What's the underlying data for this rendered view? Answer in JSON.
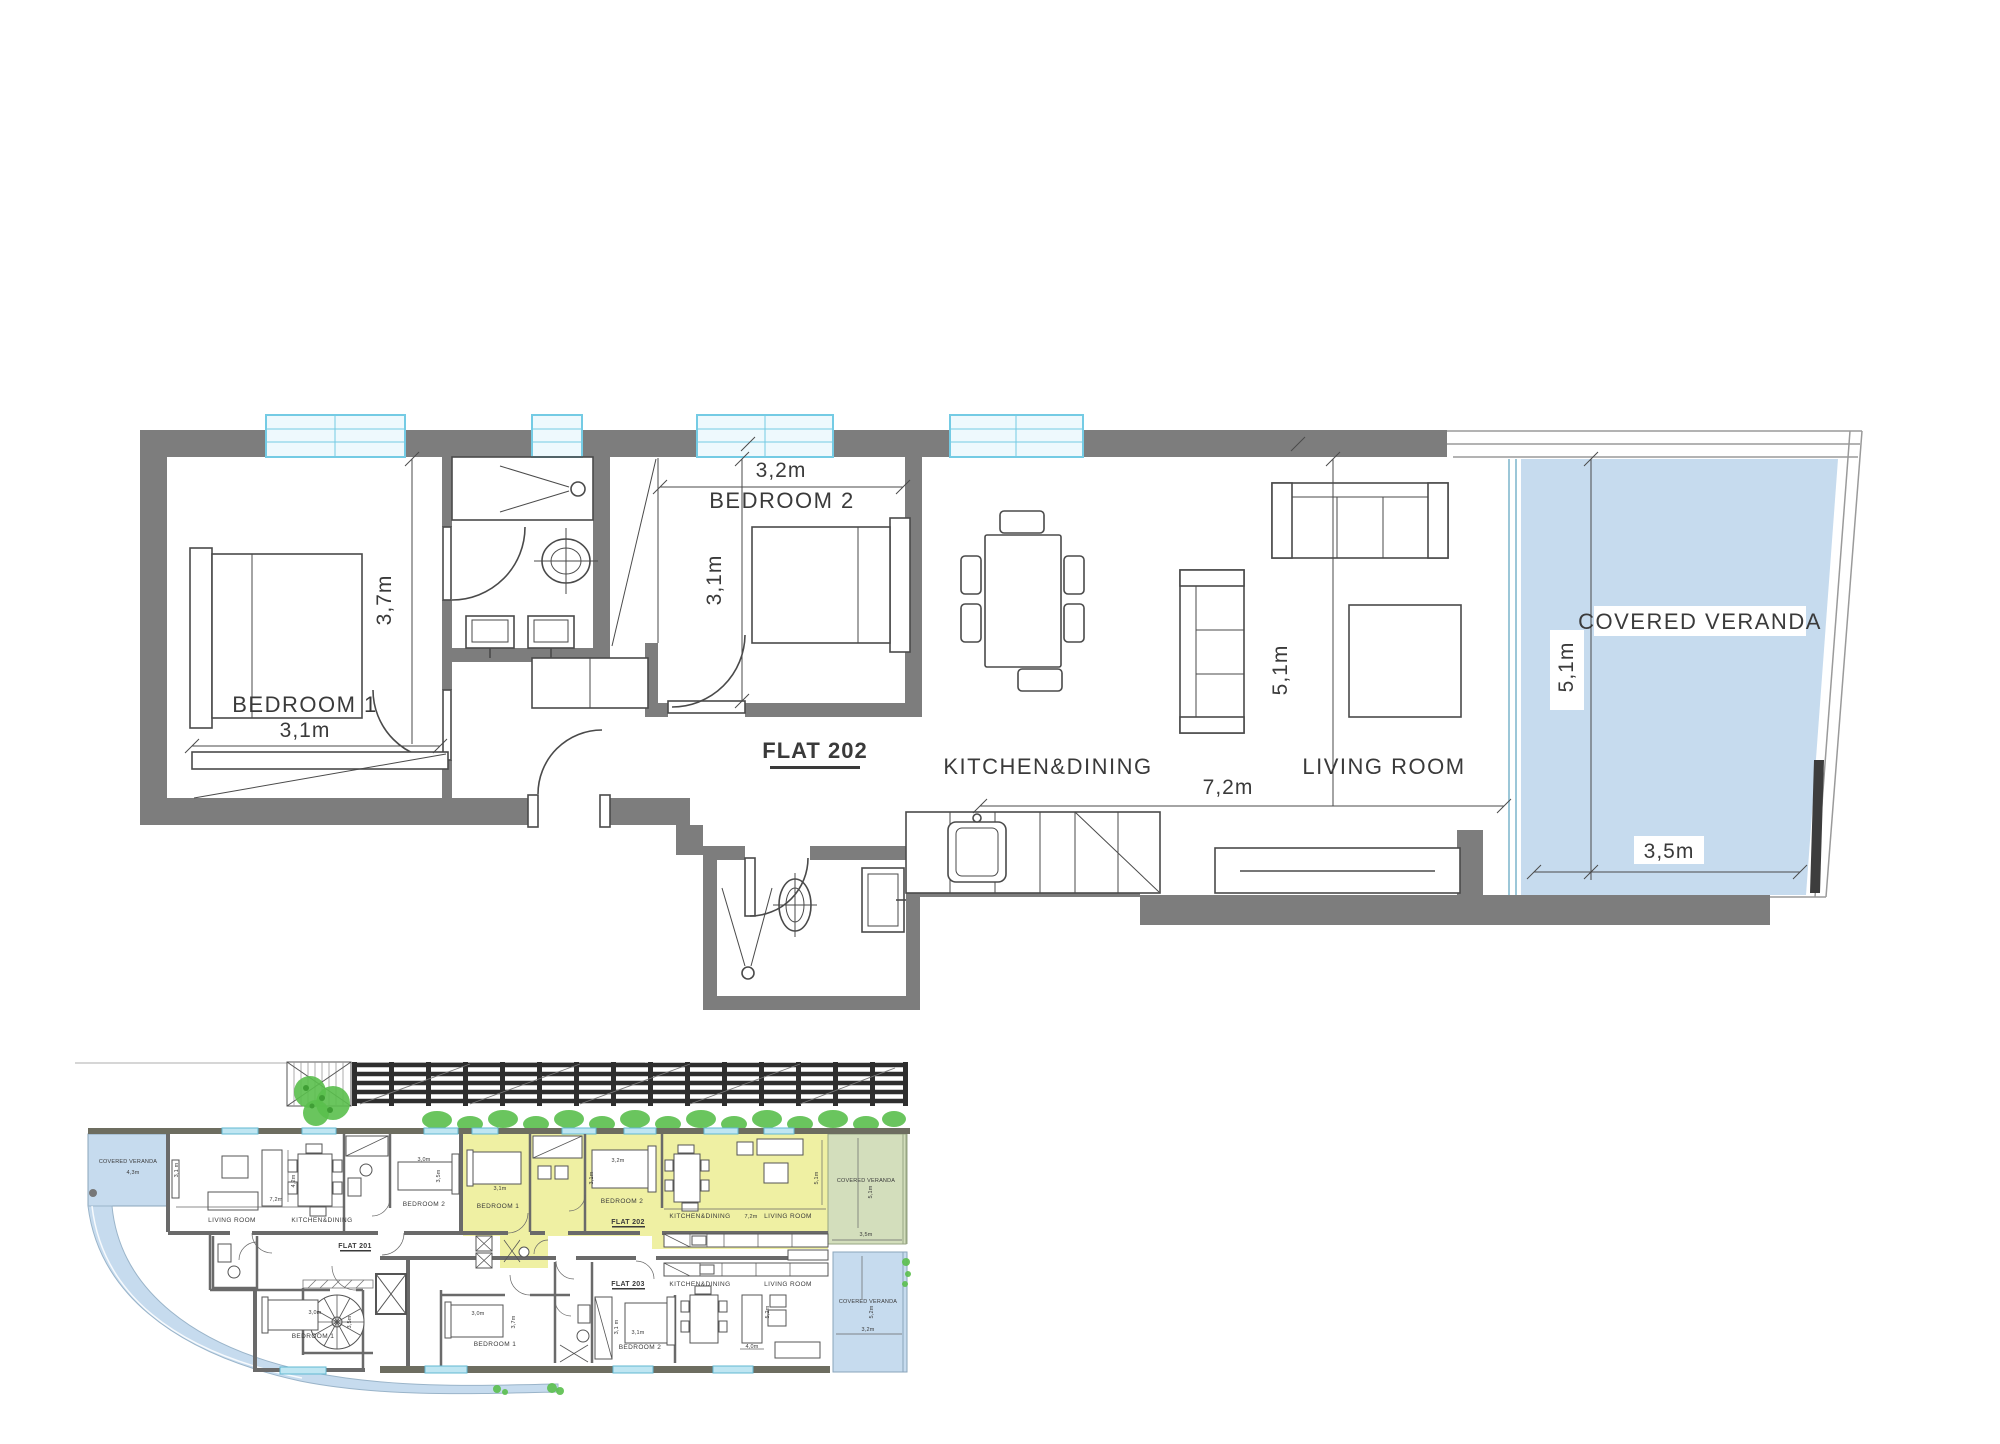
{
  "main": {
    "flat": "FLAT 202",
    "bedroom1": {
      "name": "BEDROOM 1",
      "w": "3,1m",
      "h": "3,7m"
    },
    "bedroom2": {
      "name": "BEDROOM 2",
      "w": "3,2m",
      "h": "3,1m"
    },
    "kitchen": {
      "name": "KITCHEN&DINING",
      "w": "7,2m"
    },
    "living": {
      "name": "LIVING ROOM",
      "h": "5,1m"
    },
    "veranda": {
      "name": "COVERED VERANDA",
      "w": "3,5m",
      "h": "5,1m"
    }
  },
  "overview": {
    "f201": {
      "flat": "FLAT 201",
      "veranda": "COVERED VERANDA",
      "veranda_w": "4,3m",
      "veranda_h": "3,1 m",
      "living": "LIVING ROOM",
      "kitchen": "KITCHEN&DINING",
      "kitchen_w": "7,2m",
      "kitchen_h": "4,2m",
      "bed2": "BEDROOM 2",
      "bed2_w": "3,0m",
      "bed2_h": "3,5m",
      "bed1": "BEDROOM 1",
      "bed1_w": "3,0m",
      "bed1_h": "3,5m"
    },
    "f202": {
      "flat": "FLAT 202",
      "bed1": "BEDROOM 1",
      "bed1_w": "3,1m",
      "bed2": "BEDROOM 2",
      "bed2_w": "3,2m",
      "bed2_h": "3,1m",
      "kitchen": "KITCHEN&DINING",
      "kitchen_w": "7,2m",
      "living": "LIVING ROOM",
      "living_h": "5,1m",
      "veranda": "COVERED VERANDA",
      "veranda_w": "3,5m",
      "veranda_h": "5,1m"
    },
    "f203": {
      "flat": "FLAT 203",
      "kitchen": "KITCHEN&DINING",
      "living": "LIVING ROOM",
      "living_w": "4,0m",
      "living_h": "5,2m",
      "bed1": "BEDROOM 1",
      "bed1_w": "3,0m",
      "bed1_h": "3,7m",
      "bed2": "BEDROOM 2",
      "bed2_w": "3,1m",
      "bed2_h": "3,1 m",
      "veranda": "COVERED VERANDA",
      "veranda_w": "3,2m",
      "veranda_h": "5,2m"
    }
  },
  "colors": {
    "wall": "#7d7d7d",
    "veranda_blue": "#c6dbee",
    "flat_highlight_yellow": "#eff0a3",
    "veranda_green": "#d3debc",
    "window_cyan": "#74cbe4",
    "shrub_green": "#5abf4d",
    "ink": "#3a3a3a"
  }
}
